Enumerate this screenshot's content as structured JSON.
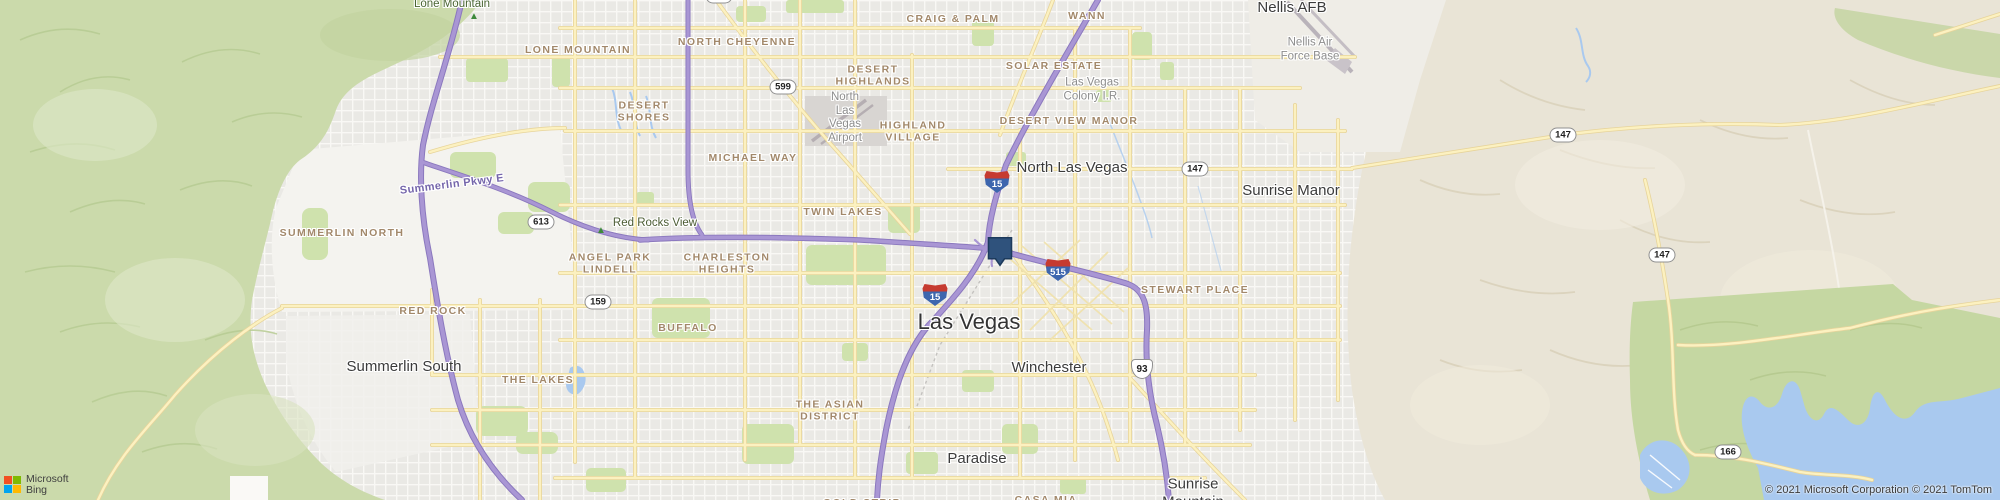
{
  "map": {
    "labels": [
      {
        "name": "lone-mountain-peak",
        "type": "peak",
        "text": "Lone Mountain",
        "x": 452,
        "y": 5
      },
      {
        "name": "lone-mountain-peak-icon",
        "type": "tri",
        "text": "▲",
        "x": 474,
        "y": 17
      },
      {
        "name": "lone-mountain",
        "type": "nbhd",
        "text": "LONE MOUNTAIN",
        "x": 578,
        "y": 50
      },
      {
        "name": "north-cheyenne",
        "type": "nbhd",
        "text": "NORTH CHEYENNE",
        "x": 737,
        "y": 42
      },
      {
        "name": "craig-and-palm",
        "type": "nbhd",
        "text": "CRAIG & PALM",
        "x": 953,
        "y": 19
      },
      {
        "name": "wann",
        "type": "nbhd",
        "text": "WANN",
        "x": 1087,
        "y": 16
      },
      {
        "name": "desert-highlands",
        "type": "nbhd",
        "text": "DESERT\nHIGHLANDS",
        "x": 873,
        "y": 76
      },
      {
        "name": "solar-estate",
        "type": "nbhd",
        "text": "SOLAR ESTATE",
        "x": 1054,
        "y": 66
      },
      {
        "name": "las-vegas-colony",
        "type": "area",
        "text": "Las Vegas\nColony I.R.",
        "x": 1092,
        "y": 90
      },
      {
        "name": "desert-view-manor",
        "type": "nbhd",
        "text": "DESERT VIEW MANOR",
        "x": 1069,
        "y": 121
      },
      {
        "name": "nellis-afb-city",
        "type": "city",
        "text": "Nellis AFB",
        "x": 1292,
        "y": 8
      },
      {
        "name": "nellis-air-force-base",
        "type": "area",
        "text": "Nellis Air\nForce Base",
        "x": 1310,
        "y": 50
      },
      {
        "name": "north-las-vegas-airport",
        "type": "area",
        "text": "North\nLas\nVegas\nAirport",
        "x": 845,
        "y": 118
      },
      {
        "name": "highland-village",
        "type": "nbhd",
        "text": "HIGHLAND\nVILLAGE",
        "x": 913,
        "y": 132
      },
      {
        "name": "desert-shores",
        "type": "nbhd",
        "text": "DESERT\nSHORES",
        "x": 644,
        "y": 112
      },
      {
        "name": "michael-way",
        "type": "nbhd",
        "text": "MICHAEL WAY",
        "x": 753,
        "y": 158
      },
      {
        "name": "north-las-vegas-city",
        "type": "city",
        "text": "North Las Vegas",
        "x": 1072,
        "y": 168
      },
      {
        "name": "sunrise-manor-city",
        "type": "city",
        "text": "Sunrise Manor",
        "x": 1291,
        "y": 191
      },
      {
        "name": "summerlin-pkwy-road",
        "type": "roadlbl",
        "text": "Summerlin Pkwy E",
        "x": 452,
        "y": 185,
        "rot": -7
      },
      {
        "name": "summerlin-north",
        "type": "nbhd",
        "text": "SUMMERLIN NORTH",
        "x": 342,
        "y": 233
      },
      {
        "name": "red-rocks-view-icon",
        "type": "tri",
        "text": "▲",
        "x": 601,
        "y": 231
      },
      {
        "name": "red-rocks-view",
        "type": "view",
        "text": "Red Rocks View",
        "x": 655,
        "y": 224
      },
      {
        "name": "twin-lakes",
        "type": "nbhd",
        "text": "TWIN LAKES",
        "x": 843,
        "y": 212
      },
      {
        "name": "angel-park-lindell",
        "type": "nbhd",
        "text": "ANGEL PARK\nLINDELL",
        "x": 610,
        "y": 264
      },
      {
        "name": "charleston-heights",
        "type": "nbhd",
        "text": "CHARLESTON\nHEIGHTS",
        "x": 727,
        "y": 264
      },
      {
        "name": "stewart-place",
        "type": "nbhd",
        "text": "STEWART PLACE",
        "x": 1195,
        "y": 290
      },
      {
        "name": "red-rock",
        "type": "nbhd",
        "text": "RED ROCK",
        "x": 433,
        "y": 311
      },
      {
        "name": "buffalo",
        "type": "nbhd",
        "text": "BUFFALO",
        "x": 688,
        "y": 328
      },
      {
        "name": "las-vegas-city",
        "type": "city-lg",
        "text": "Las Vegas",
        "x": 969,
        "y": 322
      },
      {
        "name": "winchester-city",
        "type": "city",
        "text": "Winchester",
        "x": 1049,
        "y": 368
      },
      {
        "name": "summerlin-south-city",
        "type": "city",
        "text": "Summerlin South",
        "x": 404,
        "y": 367
      },
      {
        "name": "the-lakes",
        "type": "nbhd",
        "text": "THE LAKES",
        "x": 538,
        "y": 380
      },
      {
        "name": "the-asian-district",
        "type": "nbhd",
        "text": "THE ASIAN\nDISTRICT",
        "x": 830,
        "y": 411
      },
      {
        "name": "paradise-city",
        "type": "city",
        "text": "Paradise",
        "x": 977,
        "y": 459
      },
      {
        "name": "sunrise-mountain-city",
        "type": "city",
        "text": "Sunrise\nMountain",
        "x": 1193,
        "y": 493
      },
      {
        "name": "casa-mia",
        "type": "nbhd",
        "text": "CASA MIA",
        "x": 1046,
        "y": 500
      },
      {
        "name": "gold-strip",
        "type": "nbhd",
        "text": "GOLD STRIP",
        "x": 862,
        "y": 503
      }
    ],
    "shields": [
      {
        "name": "route-shield-95-top",
        "type": "state",
        "num": "95",
        "x": 719,
        "y": -4
      },
      {
        "name": "route-shield-599",
        "type": "state",
        "num": "599",
        "x": 783,
        "y": 87
      },
      {
        "name": "route-shield-i15-north",
        "type": "interstate",
        "num": "15",
        "x": 997,
        "y": 182
      },
      {
        "name": "route-shield-i15-south",
        "type": "interstate",
        "num": "15",
        "x": 935,
        "y": 295
      },
      {
        "name": "route-shield-i515",
        "type": "interstate",
        "num": "515",
        "x": 1058,
        "y": 270
      },
      {
        "name": "route-shield-93",
        "type": "us",
        "num": "93",
        "x": 1142,
        "y": 369
      },
      {
        "name": "route-shield-147-a",
        "type": "state",
        "num": "147",
        "x": 1195,
        "y": 169
      },
      {
        "name": "route-shield-147-b",
        "type": "state",
        "num": "147",
        "x": 1563,
        "y": 135
      },
      {
        "name": "route-shield-147-c",
        "type": "state",
        "num": "147",
        "x": 1662,
        "y": 255
      },
      {
        "name": "route-shield-159",
        "type": "state",
        "num": "159",
        "x": 598,
        "y": 302
      },
      {
        "name": "route-shield-613",
        "type": "state",
        "num": "613",
        "x": 541,
        "y": 222
      },
      {
        "name": "route-shield-166",
        "type": "state",
        "num": "166",
        "x": 1728,
        "y": 452
      }
    ],
    "marker": {
      "x": 1000,
      "y": 265
    }
  },
  "attribution": {
    "logo_line1": "Microsoft",
    "logo_line2": "Bing",
    "copyright": "© 2021 Microsoft Corporation © 2021 TomTom"
  },
  "theme": {
    "marker_fill": "#2f527c",
    "marker_stroke": "#1c3a5c",
    "interstate_red": "#c63b30",
    "interstate_blue": "#3d66ae",
    "ms_red": "#f25022",
    "ms_green": "#7fba00",
    "ms_blue": "#00a4ef",
    "ms_yellow": "#ffb900"
  }
}
